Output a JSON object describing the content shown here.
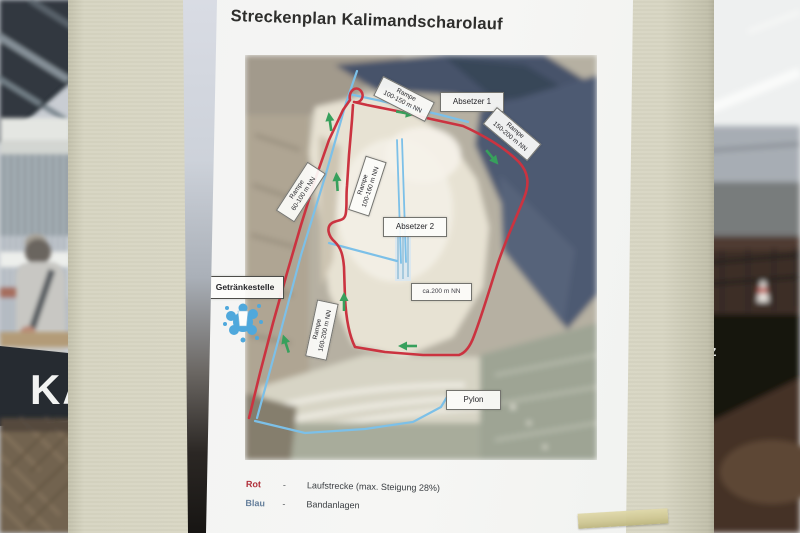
{
  "poster": {
    "title": "Streckenplan Kalimandscharolauf",
    "labels": {
      "rampe_top": {
        "line1": "Rampe",
        "line2": "100-150 m NN"
      },
      "absetzer1": "Absetzer 1",
      "rampe_right": {
        "line1": "Rampe",
        "line2": "150-200 m NN"
      },
      "rampe_left": {
        "line1": "Rampe",
        "line2": "60-100 m NN"
      },
      "rampe_mid": {
        "line1": "Rampe",
        "line2": "100-160 m NN"
      },
      "absetzer2": "Absetzer 2",
      "getraenkestelle": "Getränkestelle",
      "rampe_lower": {
        "line1": "Rampe",
        "line2": "160-200 m NN"
      },
      "ca200": "ca.200 m NN",
      "pylon": "Pylon"
    },
    "legend": {
      "rot_label": "Rot",
      "rot_dash": "-",
      "rot_desc": "Laufstrecke (max. Steigung 28%)",
      "blau_label": "Blau",
      "blau_dash": "-",
      "blau_desc": "Bandanlagen"
    }
  },
  "background": {
    "banner_text": "KA",
    "z_text": "z"
  },
  "colors": {
    "route_red": "#cb3340",
    "conveyor_blue": "#7cc0e8",
    "arrow_green": "#37a05c",
    "legend_red": "#b0303a",
    "legend_blue": "#66809c",
    "pillar_beige": "#d9d7c4",
    "paper_white": "#f4f5f3",
    "water_icon_blue": "#4fa8dc"
  }
}
